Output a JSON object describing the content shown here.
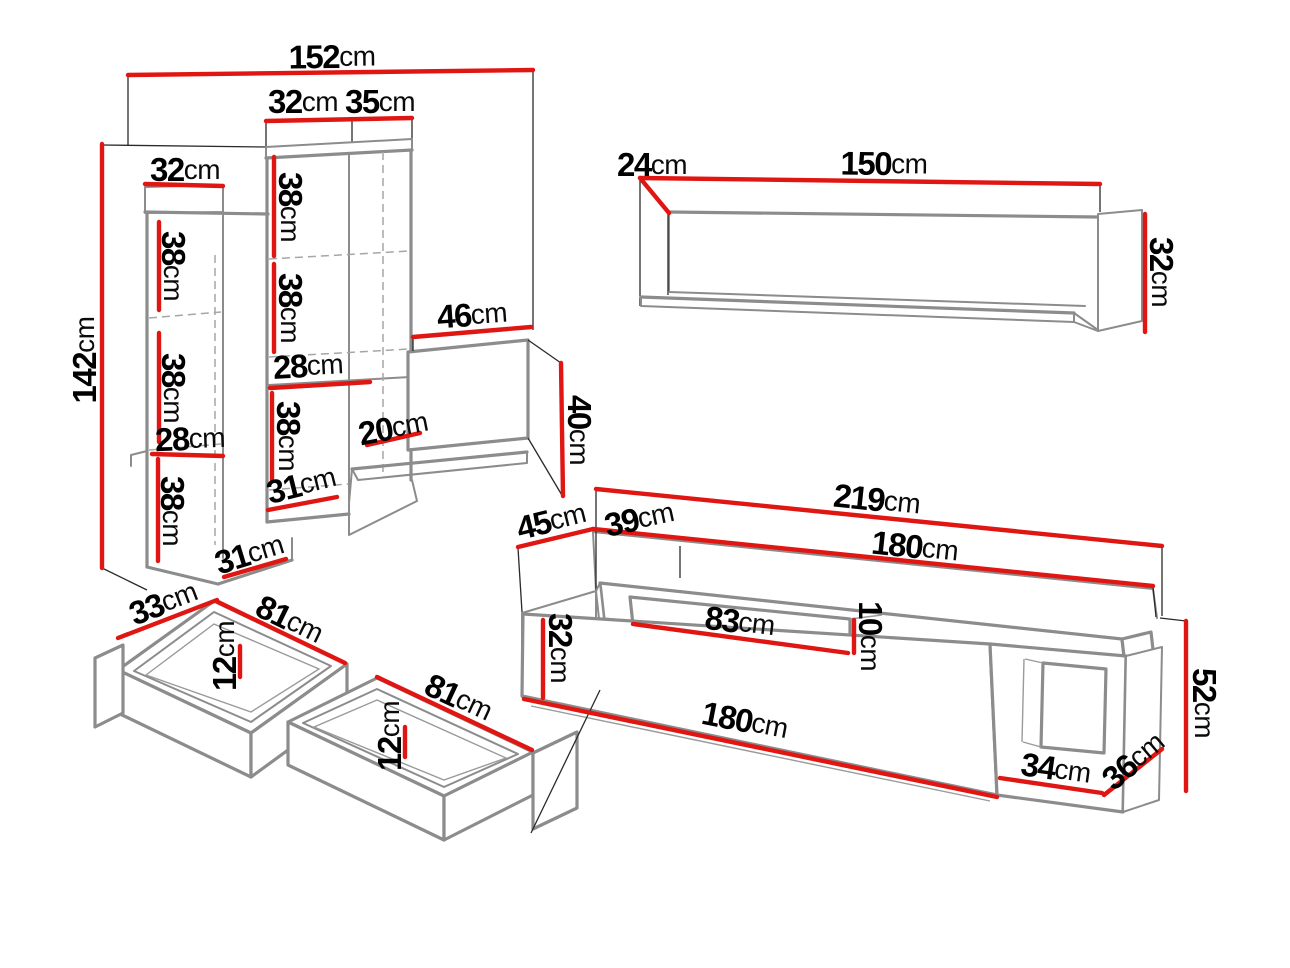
{
  "palette": {
    "dimension_red": "#e01612",
    "edge_gray": "#8c8c8c",
    "line_black": "#2a2a2a",
    "dash_gray": "#a6a6a6",
    "text_black": "#000000",
    "background": "#ffffff"
  },
  "pieces": {
    "shelving_unit": {
      "name": "tall open shelving unit",
      "labels": [
        {
          "num": "152",
          "unit": "cm"
        },
        {
          "num": "32",
          "unit": "cm"
        },
        {
          "num": "35",
          "unit": "cm"
        },
        {
          "num": "32",
          "unit": "cm"
        },
        {
          "num": "142",
          "unit": "cm"
        },
        {
          "num": "38",
          "unit": "cm"
        },
        {
          "num": "38",
          "unit": "cm"
        },
        {
          "num": "28",
          "unit": "cm"
        },
        {
          "num": "38",
          "unit": "cm"
        },
        {
          "num": "31",
          "unit": "cm"
        },
        {
          "num": "38",
          "unit": "cm"
        },
        {
          "num": "38",
          "unit": "cm"
        },
        {
          "num": "28",
          "unit": "cm"
        },
        {
          "num": "38",
          "unit": "cm"
        },
        {
          "num": "31",
          "unit": "cm"
        },
        {
          "num": "20",
          "unit": "cm"
        },
        {
          "num": "46",
          "unit": "cm"
        },
        {
          "num": "40",
          "unit": "cm"
        }
      ]
    },
    "wall_shelf": {
      "name": "wall shelf",
      "labels": [
        {
          "num": "24",
          "unit": "cm"
        },
        {
          "num": "150",
          "unit": "cm"
        },
        {
          "num": "32",
          "unit": "cm"
        }
      ]
    },
    "drawers": {
      "name": "two under-bed drawers",
      "labels": [
        {
          "num": "33",
          "unit": "cm"
        },
        {
          "num": "81",
          "unit": "cm"
        },
        {
          "num": "12",
          "unit": "cm"
        },
        {
          "num": "81",
          "unit": "cm"
        },
        {
          "num": "12",
          "unit": "cm"
        }
      ]
    },
    "tv_stand": {
      "name": "tv cabinet with top shelf deck",
      "labels": [
        {
          "num": "45",
          "unit": "cm"
        },
        {
          "num": "39",
          "unit": "cm"
        },
        {
          "num": "219",
          "unit": "cm"
        },
        {
          "num": "180",
          "unit": "cm"
        },
        {
          "num": "83",
          "unit": "cm"
        },
        {
          "num": "10",
          "unit": "cm"
        },
        {
          "num": "32",
          "unit": "cm"
        },
        {
          "num": "180",
          "unit": "cm"
        },
        {
          "num": "34",
          "unit": "cm"
        },
        {
          "num": "36",
          "unit": "cm"
        },
        {
          "num": "52",
          "unit": "cm"
        }
      ]
    }
  }
}
